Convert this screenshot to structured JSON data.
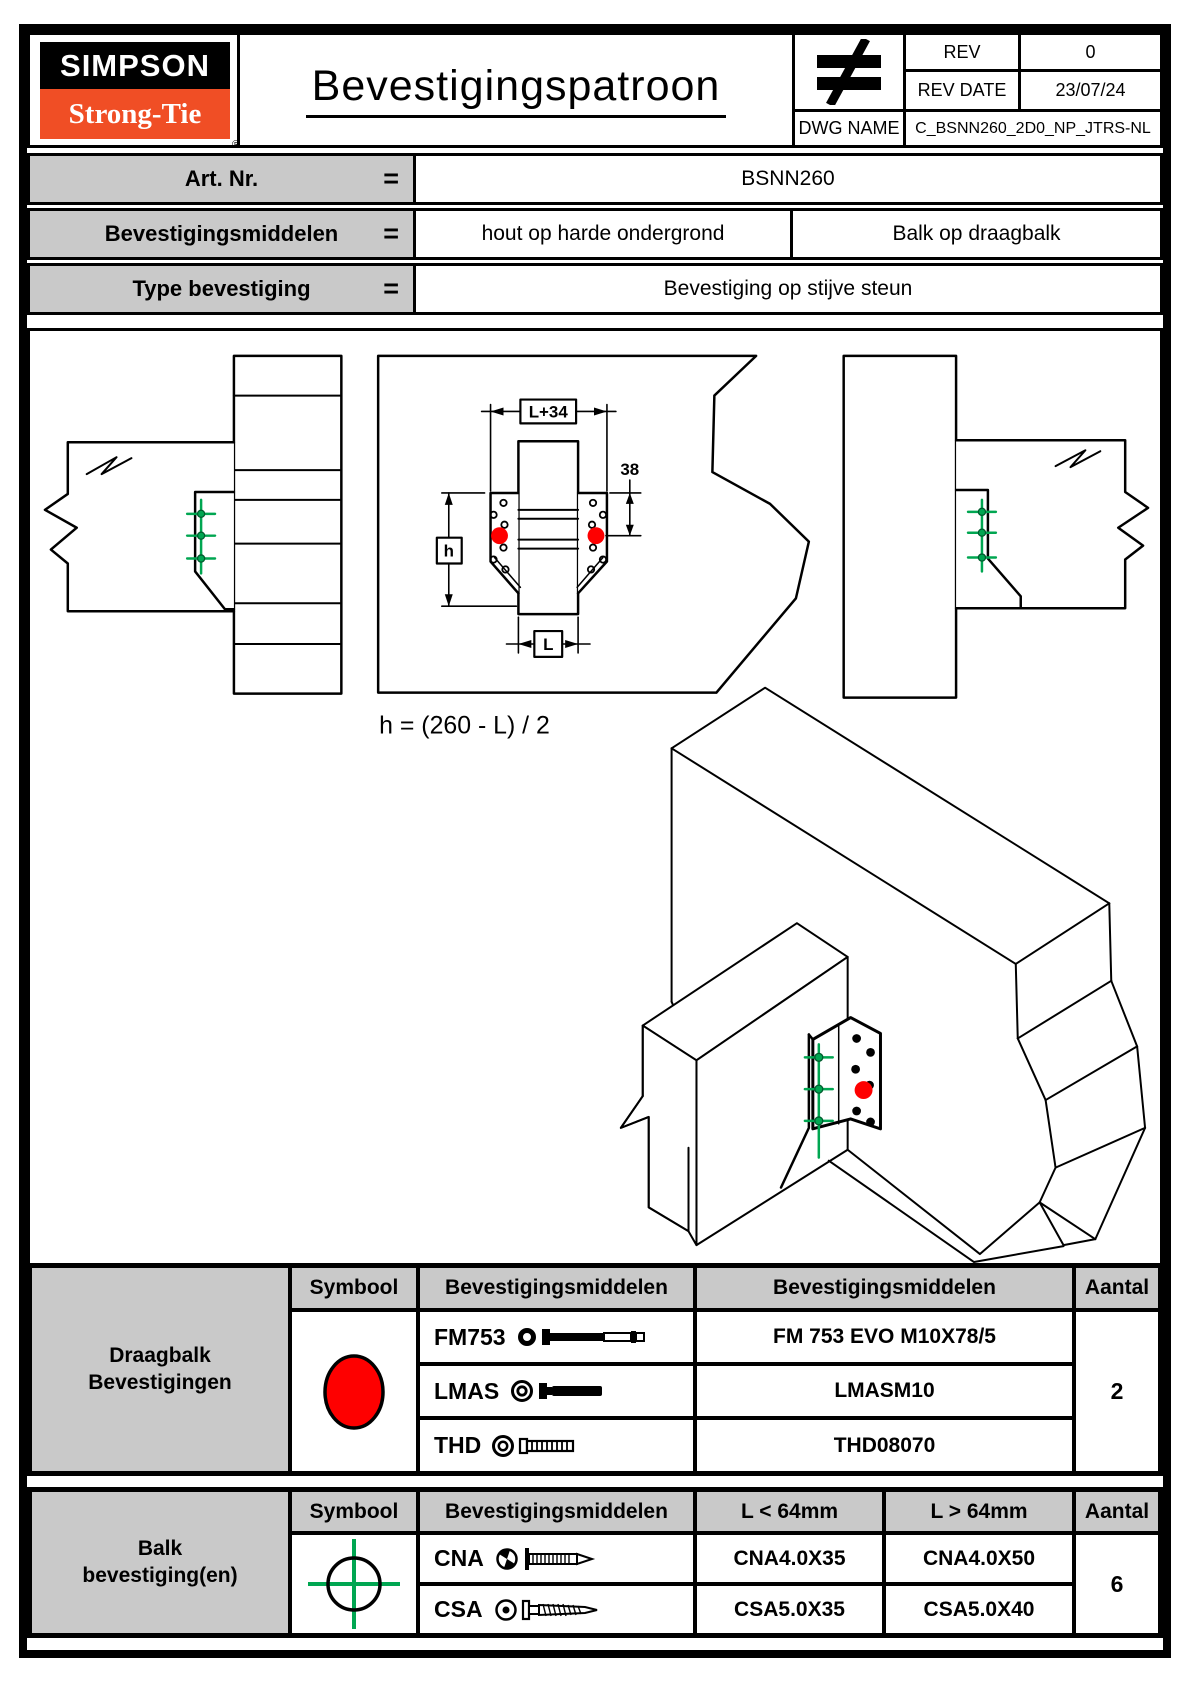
{
  "header": {
    "logo": {
      "line1": "SIMPSON",
      "line2": "Strong-Tie",
      "registered": "®"
    },
    "title": "Bevestigingspatroon",
    "rev": {
      "label": "REV",
      "value": "0"
    },
    "rev_date": {
      "label": "REV DATE",
      "value": "23/07/24"
    },
    "dwg": {
      "label": "DWG NAME",
      "value": "C_BSNN260_2D0_NP_JTRS-NL"
    }
  },
  "info": {
    "art_nr": {
      "label": "Art. Nr.",
      "eq": "=",
      "value": "BSNN260"
    },
    "middelen": {
      "label": "Bevestigingsmiddelen",
      "eq": "=",
      "value_left": "hout op harde ondergrond",
      "value_right": "Balk op draagbalk"
    },
    "type": {
      "label": "Type bevestiging",
      "eq": "=",
      "value": "Bevestiging op stijve steun"
    }
  },
  "drawing": {
    "dims": {
      "top": "L+34",
      "right": "38",
      "left": "h",
      "bottom": "L"
    },
    "formula": "h = (260 - L) / 2",
    "colors": {
      "draagbalk_fixing": "#fe0000",
      "balk_fixing": "#00a651"
    }
  },
  "table_draagbalk": {
    "group_label": "Draagbalk Bevestigingen",
    "headers": {
      "symbool": "Symbool",
      "middel": "Bevestigingsmiddelen",
      "product": "Bevestigingsmiddelen",
      "aantal": "Aantal"
    },
    "rows": [
      {
        "code": "FM753",
        "product": "FM 753 EVO M10X78/5"
      },
      {
        "code": "LMAS",
        "product": "LMASM10"
      },
      {
        "code": "THD",
        "product": "THD08070"
      }
    ],
    "aantal": "2"
  },
  "table_balk": {
    "group_label": "Balk bevestiging(en)",
    "headers": {
      "symbool": "Symbool",
      "middel": "Bevestigingsmiddelen",
      "short": "L < 64mm",
      "long": "L > 64mm",
      "aantal": "Aantal"
    },
    "rows": [
      {
        "code": "CNA",
        "short": "CNA4.0X35",
        "long": "CNA4.0X50"
      },
      {
        "code": "CSA",
        "short": "CSA5.0X35",
        "long": "CSA5.0X40"
      }
    ],
    "aantal": "6"
  }
}
